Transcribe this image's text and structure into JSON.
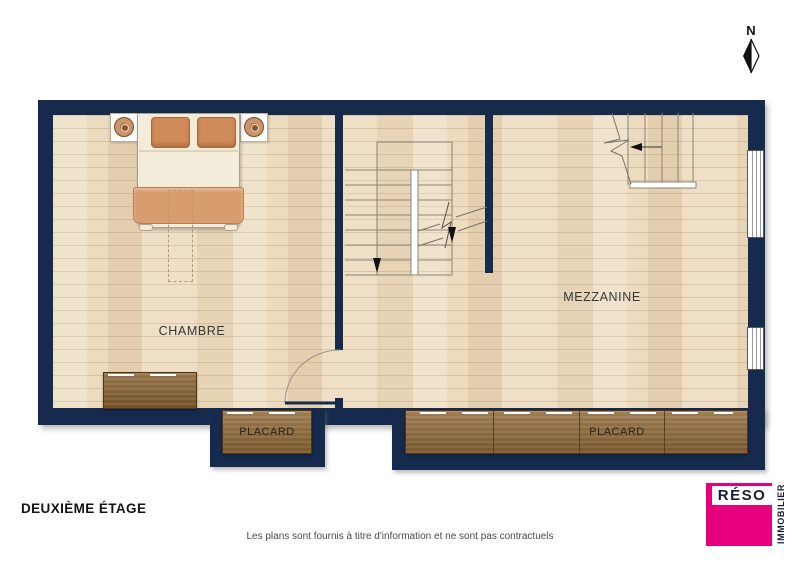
{
  "plan": {
    "north_label": "N",
    "floor_label": "DEUXIÈME ÉTAGE",
    "disclaimer": "Les plans sont fournis à titre d'information et ne sont pas contractuels",
    "rooms": [
      {
        "id": "chambre",
        "label": "CHAMBRE"
      },
      {
        "id": "mezzanine",
        "label": "MEZZANINE"
      }
    ],
    "closets": [
      {
        "id": "placard-left",
        "label": "PLACARD"
      },
      {
        "id": "placard-right",
        "label": "PLACARD"
      }
    ],
    "features": [
      "double-bed with two pillows and two nightstands",
      "dresser against chambre south wall",
      "u-shaped main staircase with down arrow and break line",
      "straight mezzanine staircase with break line at top wall",
      "door swing between chambre and mezzanine",
      "two windows on east wall"
    ]
  },
  "icons": {
    "north_arrow": "compass-north-diamond",
    "main_staircase": "u-shaped-staircase",
    "mezzanine_staircase": "straight-staircase",
    "door": "door-swing-arc",
    "lamp": "round-lamp-on-nightstand"
  },
  "logo": {
    "brand": "RÉSO",
    "tagline": "IMMOBILIER",
    "color": "#e6007e"
  },
  "colors": {
    "wall": "#162a4d",
    "floor": "#ecdbbe",
    "wood_furniture": "#936b39",
    "bed_textile": "#d89d6e",
    "accent_pink": "#e6007e"
  }
}
